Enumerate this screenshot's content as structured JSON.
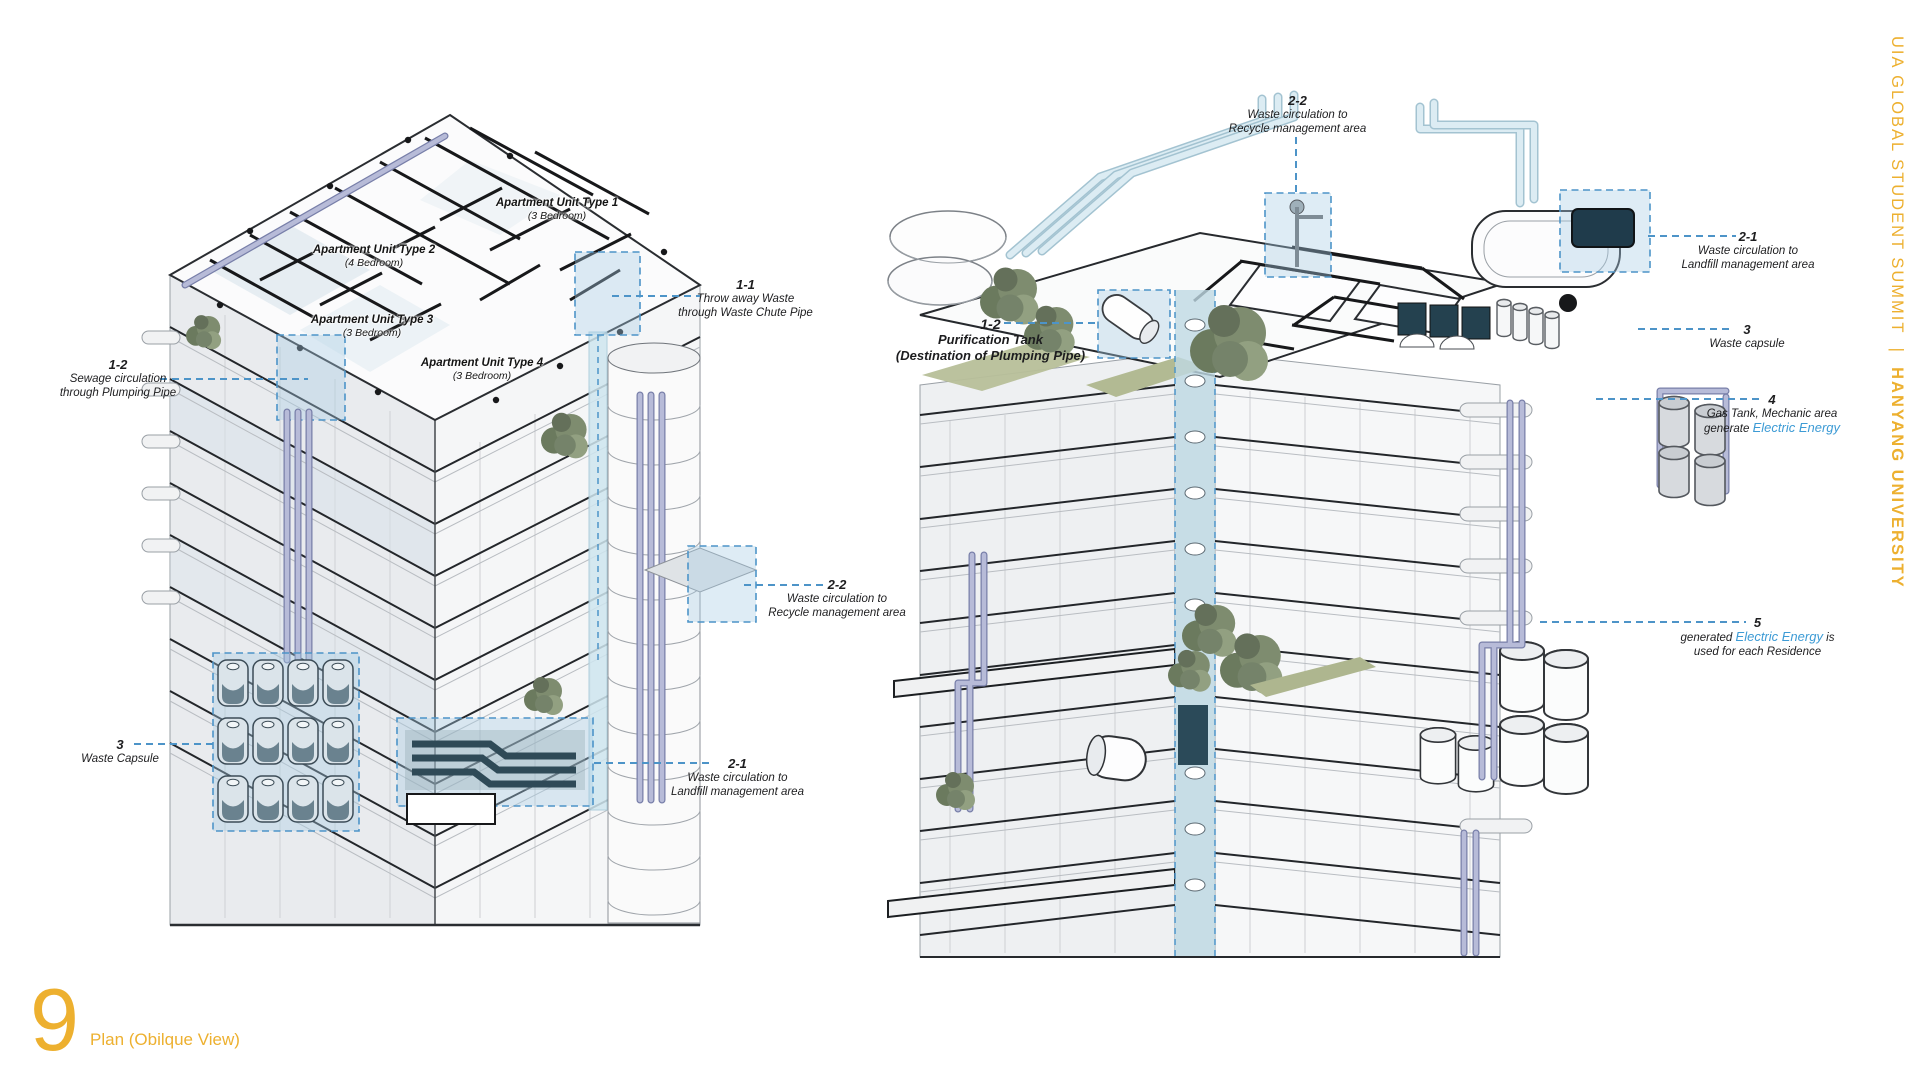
{
  "side_banner": {
    "summit": "UIA GLOBAL STUDENT SUMMIT",
    "separator": "|",
    "university": "HANYANG UNIVERSITY",
    "color": "#EDB02F"
  },
  "footer": {
    "page_number": "9",
    "caption": "Plan (Obilque View)"
  },
  "left_view": {
    "apartments": [
      {
        "name": "Apartment Unit Type 1",
        "sub": "(3 Bedroom)"
      },
      {
        "name": "Apartment Unit Type 2",
        "sub": "(4 Bedroom)"
      },
      {
        "name": "Apartment Unit Type 3",
        "sub": "(3 Bedroom)"
      },
      {
        "name": "Apartment Unit Type 4",
        "sub": "(3 Bedroom)"
      }
    ],
    "annotations": [
      {
        "id": "1-1",
        "line1": "Throw away Waste",
        "line2": "through Waste Chute Pipe"
      },
      {
        "id": "1-2",
        "line1": "Sewage circulation",
        "line2": "through Plumping Pipe"
      },
      {
        "id": "2-2",
        "line1": "Waste circulation to",
        "line2": "Recycle management area"
      },
      {
        "id": "2-1",
        "line1": "Waste circulation to",
        "line2": "Landfill management area"
      },
      {
        "id": "3",
        "line1": "Waste Capsule"
      }
    ]
  },
  "right_view": {
    "annotations": [
      {
        "id": "2-2",
        "line1": "Waste circulation to",
        "line2": "Recycle management area"
      },
      {
        "id": "2-1",
        "line1": "Waste circulation to",
        "line2": "Landfill management area"
      },
      {
        "id": "1-2",
        "line1": "Purification Tank",
        "line2": "(Destination of Plumping Pipe)"
      },
      {
        "id": "3",
        "line1": "Waste capsule"
      },
      {
        "id": "4",
        "line1": "Gas Tank, Mechanic area",
        "line2_prefix": "generate ",
        "line2_em": "Electric Energy"
      },
      {
        "id": "5",
        "line1_prefix": "generated ",
        "line1_em": "Electric Energy",
        "line1_suffix": " is",
        "line2": "used for each Residence"
      }
    ]
  },
  "colors": {
    "accent_blue": "#3D9BD5",
    "leader_blue": "#4D94C8",
    "brand_yellow": "#EDB02F",
    "pipe_lavender": "#B7BBD8",
    "pipe_cyan": "#DCECF3",
    "pipe_dark": "#2F4A57",
    "highlight_fill": "#A8CDE5"
  }
}
